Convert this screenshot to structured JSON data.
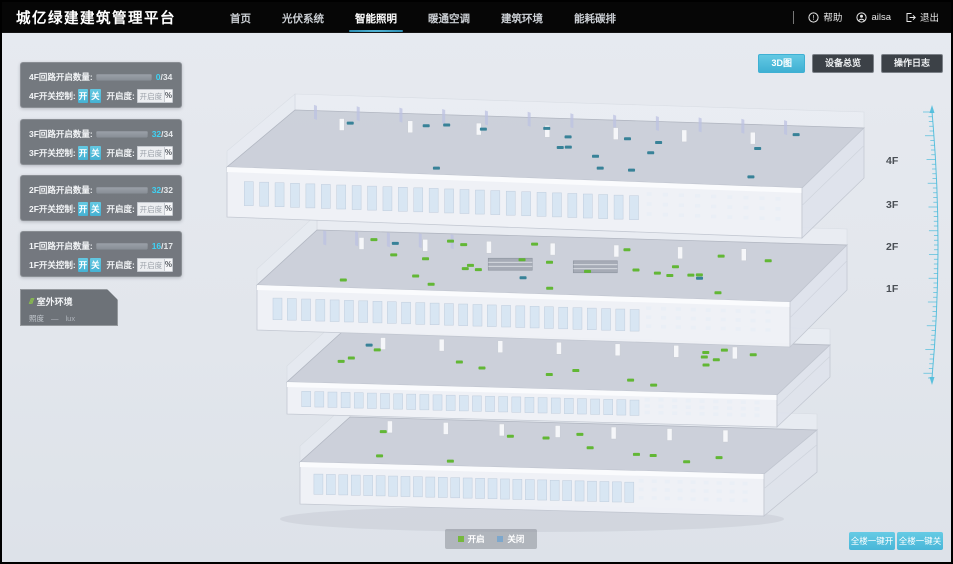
{
  "header": {
    "title": "城亿绿建建筑管理平台",
    "nav": [
      {
        "label": "首页",
        "active": false
      },
      {
        "label": "光伏系统",
        "active": false
      },
      {
        "label": "智能照明",
        "active": true
      },
      {
        "label": "暖通空调",
        "active": false
      },
      {
        "label": "建筑环境",
        "active": false
      },
      {
        "label": "能耗碳排",
        "active": false
      }
    ],
    "help_label": "帮助",
    "user_name": "ailsa",
    "logout_label": "退出"
  },
  "toolbar": {
    "buttons": [
      {
        "label": "3D图",
        "active": true
      },
      {
        "label": "设备总览",
        "active": false
      },
      {
        "label": "操作日志",
        "active": false
      }
    ]
  },
  "floor_panels": [
    {
      "circuit_label": "4F回路开启数量:",
      "on_count": "0",
      "total_suffix": "/34",
      "switch_label": "4F开关控制:",
      "on_btn": "开",
      "off_btn": "关",
      "dim_label": "开启度:",
      "dim_placeholder": "开启度",
      "percent_label": "%"
    },
    {
      "circuit_label": "3F回路开启数量:",
      "on_count": "32",
      "total_suffix": "/34",
      "switch_label": "3F开关控制:",
      "on_btn": "开",
      "off_btn": "关",
      "dim_label": "开启度:",
      "dim_placeholder": "开启度",
      "percent_label": "%"
    },
    {
      "circuit_label": "2F回路开启数量:",
      "on_count": "32",
      "total_suffix": "/32",
      "switch_label": "2F开关控制:",
      "on_btn": "开",
      "off_btn": "关",
      "dim_label": "开启度:",
      "dim_placeholder": "开启度",
      "percent_label": "%"
    },
    {
      "circuit_label": "1F回路开启数量:",
      "on_count": "16",
      "total_suffix": "/17",
      "switch_label": "1F开关控制:",
      "on_btn": "开",
      "off_btn": "关",
      "dim_label": "开启度:",
      "dim_placeholder": "开启度",
      "percent_label": "%"
    }
  ],
  "outdoor": {
    "title": "室外环境",
    "icon": "slash-stripes-icon",
    "metric_label": "照度",
    "metric_value": "—",
    "metric_unit": "lux"
  },
  "floor_scale": {
    "labels": [
      "4F",
      "3F",
      "2F",
      "1F"
    ]
  },
  "legend": {
    "items": [
      {
        "label": "开启",
        "color": "#76b83d"
      },
      {
        "label": "关闭",
        "color": "#7da7cc"
      }
    ]
  },
  "bulk_buttons": [
    {
      "label": "全楼一键开"
    },
    {
      "label": "全楼一键关"
    }
  ],
  "building": {
    "floors": [
      {
        "name": "4F",
        "markers_on": 0,
        "markers_off": 18
      },
      {
        "name": "3F",
        "markers_on": 26,
        "markers_off": 3
      },
      {
        "name": "2F",
        "markers_on": 15,
        "markers_off": 1
      },
      {
        "name": "1F",
        "markers_on": 11,
        "markers_off": 0
      }
    ]
  },
  "colors": {
    "accent": "#4bbbdb",
    "marker_on": "#5cb52c",
    "marker_off": "#2f7d95",
    "bar_fill": "#38c6ec"
  }
}
